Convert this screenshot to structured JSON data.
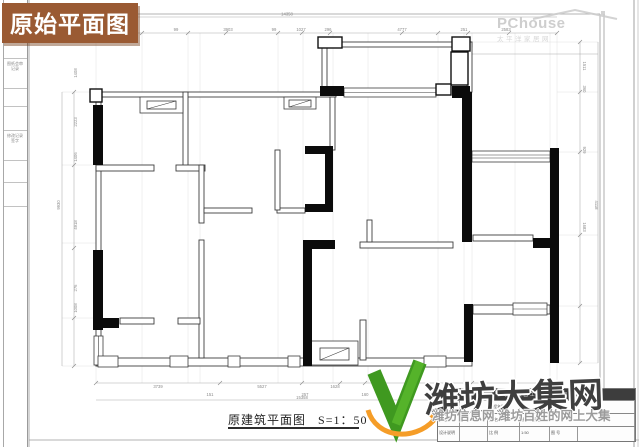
{
  "corner_label": {
    "text": "原始平面图"
  },
  "watermarks": {
    "pchouse": {
      "brand": "PChouse",
      "subtitle": "太平洋家居网"
    },
    "daji": {
      "brand": "潍坊大集网",
      "tagline": "潍坊信息网 潍坊百姓的网上大集"
    }
  },
  "plan": {
    "title": "原建筑平面图",
    "scale": "S=1：50",
    "dims": {
      "top_total": "14358",
      "top": [
        "2680",
        "99",
        "3903",
        "99",
        "1027",
        "296",
        "4777",
        "251",
        "2583"
      ],
      "left": [
        "1408",
        "2223",
        "1406",
        "4918",
        "276",
        "1008"
      ],
      "left_total": "9930",
      "right": [
        "1511",
        "360",
        "929",
        "1683"
      ],
      "right_total": "4118",
      "bottom": [
        "3739",
        "5527",
        "1628"
      ],
      "bottom_small": [
        "151",
        "257",
        "160"
      ],
      "bottom_total": "15358"
    }
  },
  "title_block": {
    "company": "装饰集团工程有限公司",
    "labels": {
      "approve": "审 定",
      "check": "审 核",
      "notes": "设计说明",
      "project": "工程名称",
      "drawing_name": "图 名",
      "scale": "比 例",
      "number": "图 号"
    },
    "values": {
      "drawing_name": "原建筑平面图",
      "scale": "1:50"
    }
  },
  "side_strip": {
    "block1": "图纸会审记录",
    "block2": "修改记录签字"
  }
}
